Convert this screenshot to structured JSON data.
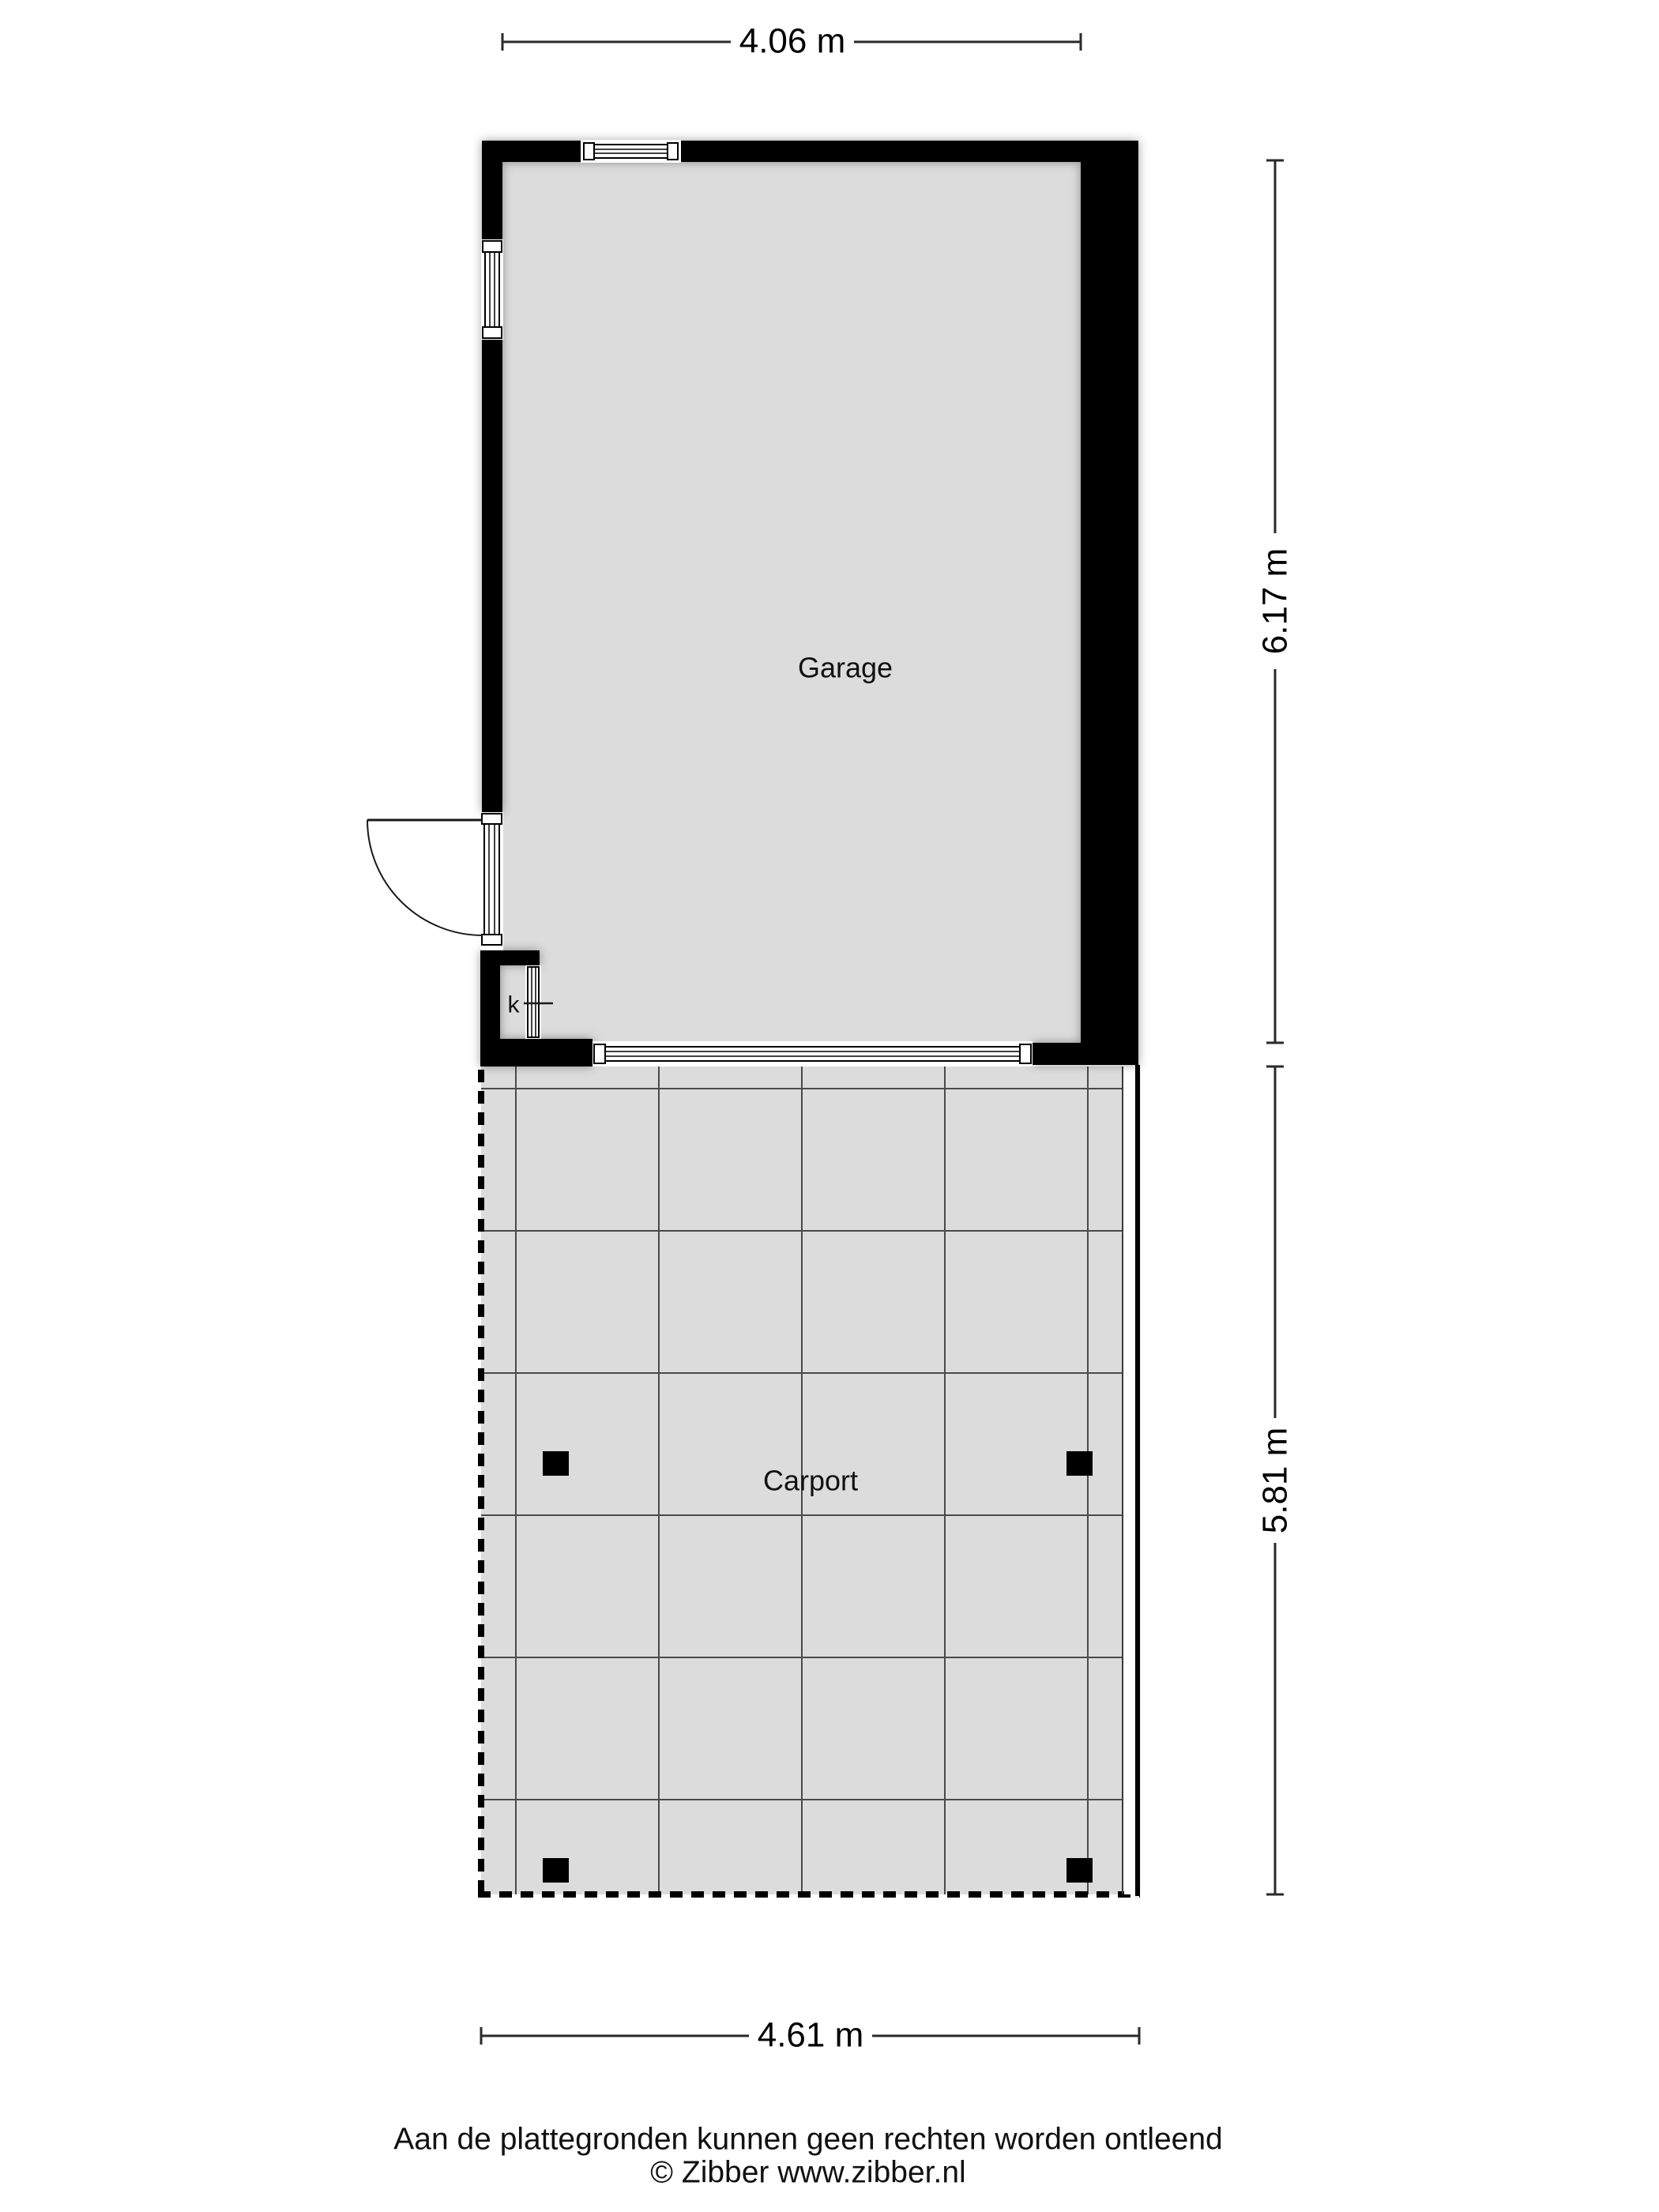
{
  "plan": {
    "rooms": [
      {
        "label": "Garage"
      },
      {
        "label": "Carport"
      }
    ],
    "closet": {
      "label": "k"
    },
    "dimensions": {
      "top": "4.06 m",
      "right_upper": "6.17 m",
      "right_lower": "5.81 m",
      "bottom": "4.61 m"
    },
    "footer": {
      "line1": "Aan de plattegronden kunnen geen rechten worden ontleend",
      "line2": "© Zibber www.zibber.nl"
    },
    "colors": {
      "wall": "#000000",
      "floor": "#dcdcdc",
      "grid_line": "#4a4a4a",
      "background": "#ffffff"
    }
  }
}
